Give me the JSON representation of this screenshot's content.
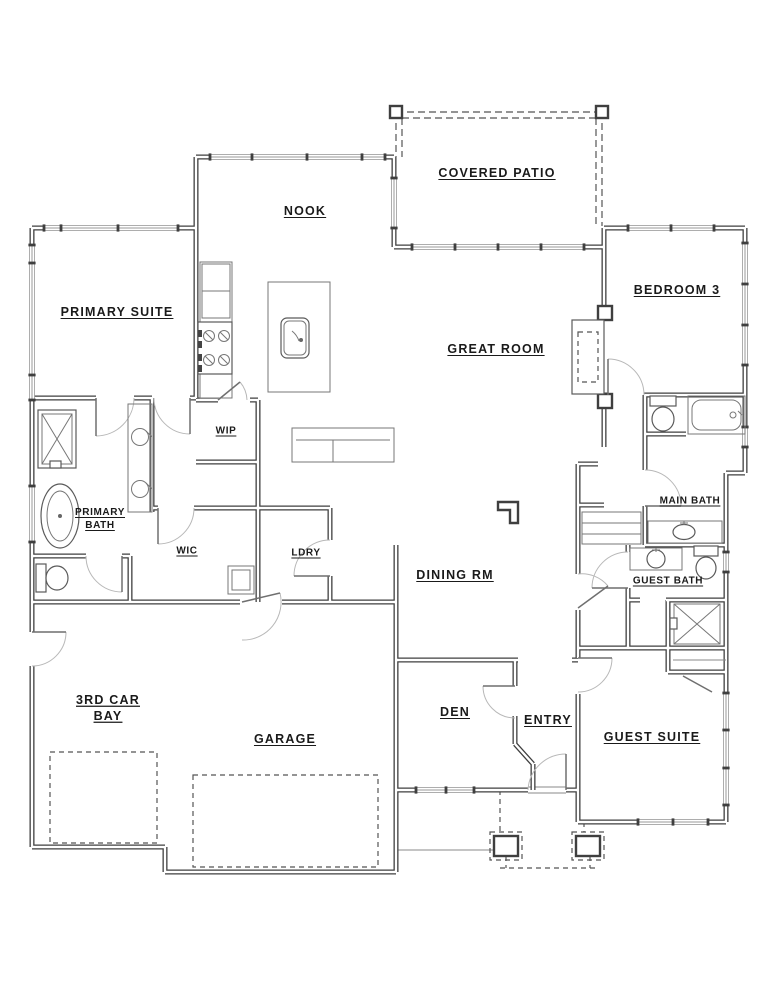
{
  "rooms": {
    "covered_patio": "COVERED PATIO",
    "nook": "NOOK",
    "primary_suite": "PRIMARY SUITE",
    "bedroom_3": "BEDROOM 3",
    "great_room": "GREAT ROOM",
    "wip": "WIP",
    "primary_bath": {
      "line1": "PRIMARY",
      "line2": "BATH"
    },
    "wic": "WIC",
    "ldry": "LDRY",
    "dining_rm": "DINING RM",
    "main_bath": "MAIN BATH",
    "guest_bath": "GUEST BATH",
    "third_car_bay": {
      "line1": "3RD CAR",
      "line2": "BAY"
    },
    "garage": "GARAGE",
    "den": "DEN",
    "entry": "ENTRY",
    "guest_suite": "GUEST SUITE"
  },
  "fixtures": [
    "kitchen-fridge",
    "kitchen-range",
    "kitchen-island-sink",
    "fireplace",
    "primary-shower",
    "primary-freestanding-tub",
    "primary-vanity-double-sinks",
    "water-closet-toilet",
    "main-bath-toilet",
    "main-bath-tub",
    "main-bath-sink",
    "guest-bath-sink",
    "guest-bath-toilet",
    "guest-shower",
    "garage-door-panels",
    "patio-posts",
    "porch-columns"
  ],
  "colors": {
    "wall": "#3f3f3f",
    "thin_line": "#8a8a8a",
    "door_arc": "#b8b8b8",
    "dashed": "#555555",
    "text": "#1a1a1a",
    "background": "#ffffff"
  }
}
